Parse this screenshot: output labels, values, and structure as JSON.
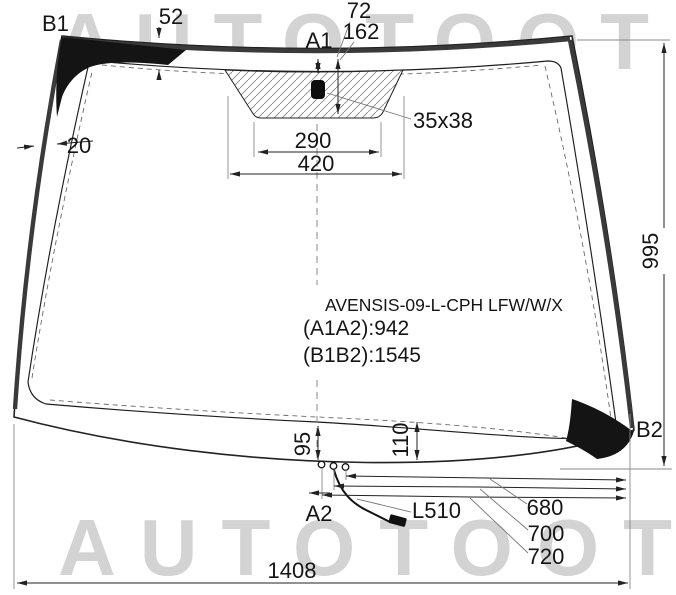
{
  "watermarks": {
    "top": "AUTOTOOT",
    "bottom": "AUTOTOOT"
  },
  "part_info": {
    "code": "AVENSIS-09-L-CPH LFW/W/X",
    "dim_a1a2": "(A1A2):942",
    "dim_b1b2": "(B1B2):1545"
  },
  "point_labels": {
    "b1": "B1",
    "b2": "B2",
    "a1": "A1",
    "a2": "A2"
  },
  "dimensions": {
    "top_band_width": "52",
    "sensor_top_offset": "72",
    "sensor_area_depth": "162",
    "side_band_width": "20",
    "sensor_size": "35x38",
    "bracket_inner_width": "290",
    "bracket_outer_width": "420",
    "glass_height_right": "995",
    "bottom_band_left": "95",
    "bottom_band_right": "110",
    "wire_label": "L510",
    "connector_dist_1": "680",
    "connector_dist_2": "700",
    "connector_dist_3": "720",
    "bottom_width": "1408"
  },
  "colors": {
    "line": "#222222",
    "trim_band": "#3a3a3a",
    "corner_patch": "#141414",
    "watermark": "#d3d3d3",
    "hatch": "#8a8a8a"
  }
}
